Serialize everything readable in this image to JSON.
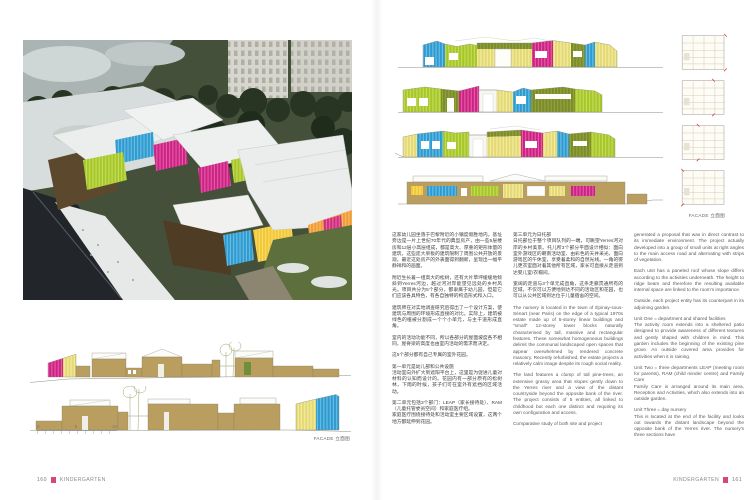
{
  "palette": {
    "accent_pink": "#d6457e",
    "magenta": "#c92383",
    "lime": "#a6c62e",
    "olive": "#7c8b2b",
    "blue": "#2f9ad0",
    "pale_yellow": "#e4d973",
    "yellow": "#f2c736",
    "orange": "#f09c3a",
    "tan": "#b99e5f",
    "green_door": "#6f8f3a",
    "roof_white": "#f4f4f0"
  },
  "left_page": {
    "page_number": "160",
    "section_title": "KINDERGARTEN",
    "facade_label": "FACADE 立面图",
    "scale_ticks": [
      "0",
      "5",
      "10"
    ],
    "photo_description": "aerial winter view of colorful kindergarten amid snow, pine trees and 1970s tower blocks"
  },
  "right_page": {
    "page_number": "161",
    "section_title": "KINDERGARTEN",
    "facade_label": "FACADE 立面图",
    "columns": {
      "col1": {
        "paragraphs": [
          "这家幼儿园坐落于巴黎附近的小镇度假胜地内。基址旁边是一片上世纪70年代的典型房产，由一些5层楼房和12层小高层组成，都是高大、厚重的矩形体量的建筑，这些庞大呆板的建筑限制了周围公共开放的景观。最近这处房产的外表面得到翻新，呈现出一幅平静祥和的画面。",
          "附近生长着一组高大的松树，还有大片草坪缓缓地倾斜到Yerres河边，越过河对岸能望见远处的乡村风光。项目共分为5个部分，都隶属于幼儿园，但是它们应该各具特色，有各自独特的构造形式和入口。",
          "建筑师在对实地调查研究后得出了一个设计方案，使建筑与周围的环境形成直接的对比。实际上，建筑被绿色的植被分割成一个个小单元，与主干道形成直角。",
          "室内的活动功能不同，所以各部分的屋面坡度各不相同，屋脊梁的高度也由室内活动的需求而决定。",
          "这5个部分都有自己专属的室外花园。",
          "第一单元是幼儿部和公共设施\n活动室向外扩大到遮阳平台上，这里是为促进儿童对材料的认知而设计的。花园内有一部分原有的松树林，下雨的时候，孩子们可在室外有遮挡的区域活动。",
          "第二单元包括3个部门：LEAP（家长接待处）、RAM（儿童托管委员空间）和家庭医疗组。\n家庭医疗围绕接待处和活动室主要区域设置，这两个地方都延伸到花园。"
        ]
      },
      "col2": {
        "paragraphs": [
          "第三单元为日托部\n日托部位于整个项目队列的一端，可眺望Yerres河对岸的乡村美景。托儿所3个部分平面设计相似：面向室外游戏区的朝南活动室、由彩色的天井采光、面向游戏区的午休室，享受着柔和的自然光线。一角的婴儿更衣室面对着其他所有区域，家长可直接从走道到达婴儿室/衣帽间。",
          "宽阔的走道与3个单元成直角，这条走廊贯通所有的区域，不仅可以方便地到达不同的活动区和花园，也可以从公共区域到达位于儿童宿舍的空间。",
          "The nursery is located in the town of Épinay-sous-Sénart (near Paris) on the edge of a typical 1970s estate made up of 5-storey linear buildings and \"small\" 12-storey tower blocks naturally characterised by tall, massive and rectangular features. These somewhat homogeneous buildings delimit the communal landscaped open spaces that appear overwhelmed by rendered concrete masonry. Recently refurbished, the estate projects a relatively calm image despite its rough social reality.",
          "The land features a clump of tall pine-trees, an extensive grassy area that slopes gently down to the Yerres river and a view of the distant countryside beyond the opposite bank of the river. The project consists of 5 entities, all linked to childhood but each one distinct and requiring its own configuration and access.",
          "Comparative study of both site and project"
        ]
      },
      "col3": {
        "paragraphs": [
          "generated a proposal that was in direct contrast to its immediate environment. The project actually developed into a group of small units at right angles to the main access road and alternating with strips of vegetation.",
          "Each unit has a paneled roof whose slope differs according to the activities underneath. The height to ridge beam and therefore the resulting available internal space are linked to the room's importance.",
          "Outside, each project entity has its counterpart in its adjoining garden.",
          "Unit One = department and shared facilities\nThe activity room extends into a sheltered patio designed to provide awareness of different textures and gently shaped with children in mind. This garden includes the beginning of the existing pine grove. An outside covered area provides for activities when it is raining.",
          "Unit Two = three departments LEAP (meeting room for parents), RAM (child minder centre) and Family Care\nFamily Care is arranged around its main area, Reception and Activities, which also extends into an outside garden.",
          "Unit Three = day nursery\nThis is located at the end of the facility and looks out towards the distant landscape beyond the opposite bank of the Yerres river. The nursery's three sections have"
        ]
      }
    }
  }
}
